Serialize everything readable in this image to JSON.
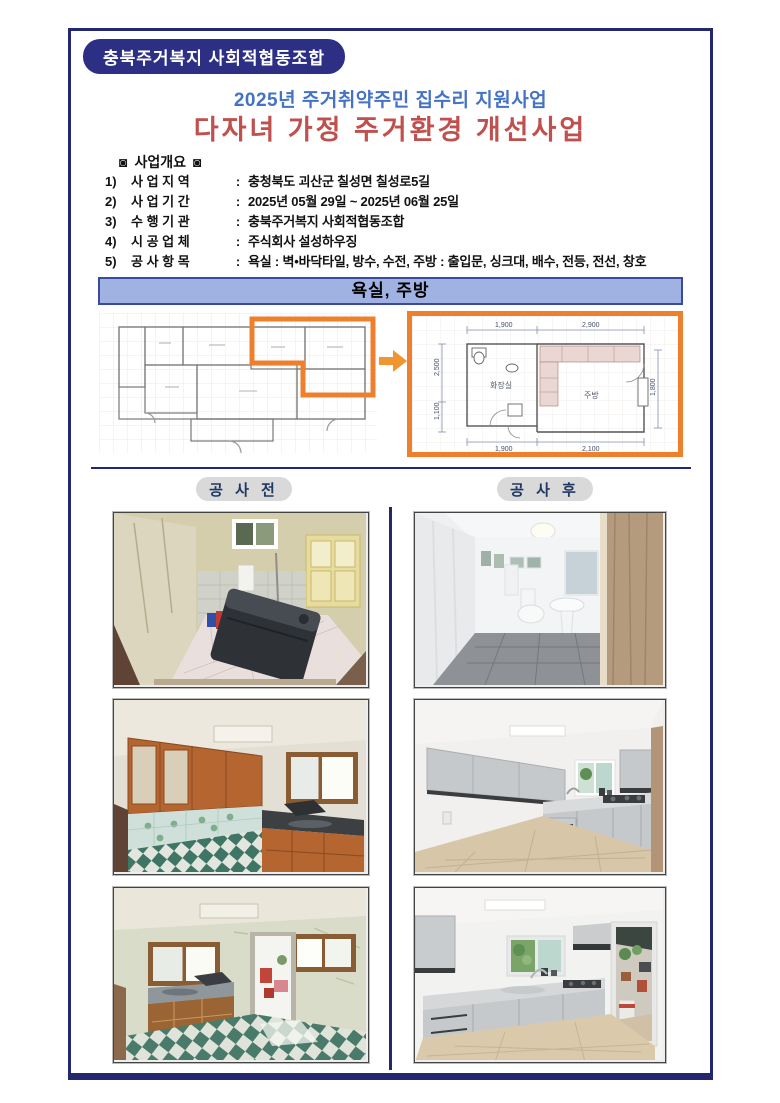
{
  "header": {
    "org_badge": "충북주거복지 사회적협동조합",
    "subtitle": "2025년 주거취약주민 집수리 지원사업",
    "title": "다자녀 가정 주거환경 개선사업"
  },
  "overview": {
    "heading_icon": "◙",
    "heading": "사업개요",
    "items": [
      {
        "no": "1)",
        "label": "사 업 지 역",
        "sep": ":",
        "value": "충청북도 괴산군 칠성면 칠성로5길"
      },
      {
        "no": "2)",
        "label": "사 업 기 간",
        "sep": ":",
        "value": "2025년 05월 29일 ~ 2025년 06월 25일"
      },
      {
        "no": "3)",
        "label": "수 행 기 관",
        "sep": ":",
        "value": "충북주거복지 사회적협동조합"
      },
      {
        "no": "4)",
        "label": "시 공 업 체",
        "sep": ":",
        "value": "주식회사 설성하우징"
      },
      {
        "no": "5)",
        "label": "공 사 항 목",
        "sep": ":",
        "value": "욕실 : 벽•바닥타일, 방수, 수전,  주방 : 출입문, 싱크대, 배수, 전등, 전선, 창호"
      }
    ]
  },
  "banner": {
    "label": "욕실, 주방"
  },
  "floorplan": {
    "detail": {
      "room_bathroom": "화장실",
      "room_kitchen": "주방",
      "dim_top_left": "1,900",
      "dim_top_right": "2,900",
      "dim_bottom_left": "1,900",
      "dim_bottom_right": "2,100",
      "dim_left_upper": "2,500",
      "dim_left_lower": "1,100",
      "dim_right": "1,800"
    }
  },
  "labels": {
    "before": "공 사 전",
    "after": "공 사 후"
  },
  "colors": {
    "frame_navy": "#23276F",
    "badge_navy": "#2D2F85",
    "title_blue": "#4472C4",
    "title_red": "#C0504D",
    "banner_blue": "#9FB2E2",
    "highlight_orange": "#EE7F2D",
    "pill_gray": "#D9D9D9",
    "pill_text_navy": "#1F3864"
  }
}
